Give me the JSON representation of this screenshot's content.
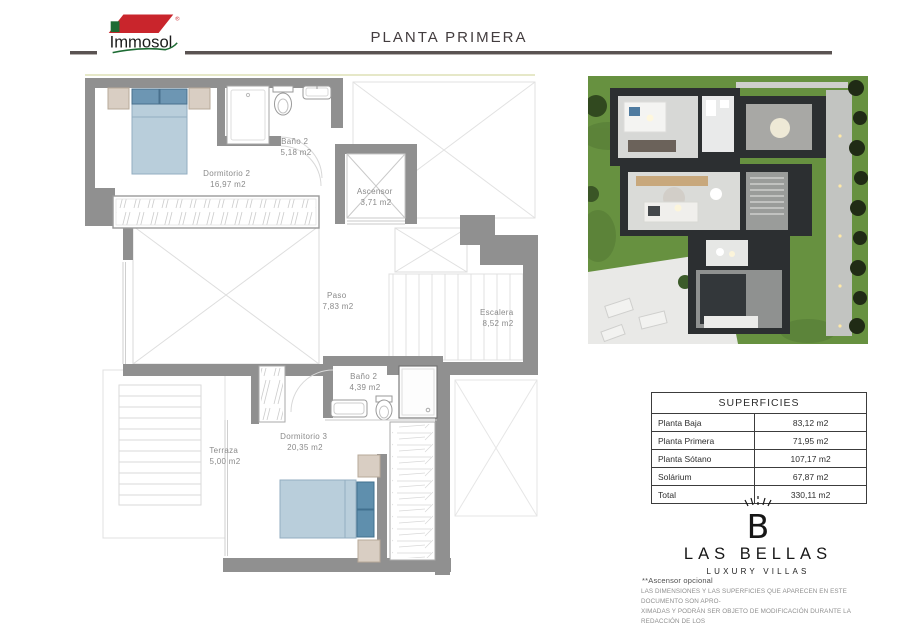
{
  "page": {
    "title": "PLANTA PRIMERA"
  },
  "logo": {
    "brand": "Immosol"
  },
  "floor_plan": {
    "rooms": [
      {
        "name": "Dormitorio 2",
        "area": "16,97 m2"
      },
      {
        "name": "Baño 2",
        "area": "5,18 m2"
      },
      {
        "name": "Ascensor",
        "area": "3,71 m2"
      },
      {
        "name": "Paso",
        "area": "7,83 m2"
      },
      {
        "name": "Escalera",
        "area": "8,52 m2"
      },
      {
        "name": "Baño 2",
        "area": "4,39 m2"
      },
      {
        "name": "Dormitorio 3",
        "area": "20,35 m2"
      },
      {
        "name": "Terraza",
        "area": "5,00 m2"
      }
    ],
    "colors": {
      "wall": "#909090",
      "bed": "#b9cedb",
      "pillow": "#6d96b3",
      "furniture_beige": "#d9cec3",
      "label": "#8a8a8a"
    }
  },
  "superficies": {
    "title": "SUPERFICIES",
    "rows": [
      {
        "label": "Planta Baja",
        "value": "83,12 m2"
      },
      {
        "label": "Planta Primera",
        "value": "71,95 m2"
      },
      {
        "label": "Planta Sótano",
        "value": "107,17 m2"
      },
      {
        "label": "Solárium",
        "value": "67,87 m2"
      },
      {
        "label": "Total",
        "value": "330,11 m2"
      }
    ]
  },
  "brand": {
    "monogram": "B",
    "name": "LAS BELLAS",
    "tagline": "LUXURY VILLAS"
  },
  "notes": {
    "elevator": "**Ascensor opcional",
    "disclaimer": "LAS DIMENSIONES Y LAS SUPERFICIES QUE APARECEN EN ESTE DOCUMENTO SON APRO-\nXIMADAS Y PODRÁN SER OBJETO DE MODIFICACIÓN DURANTE LA REDACCIÓN DE LOS\nPROYECTOS BÁSICO Y DE EJECUCIÓN"
  }
}
